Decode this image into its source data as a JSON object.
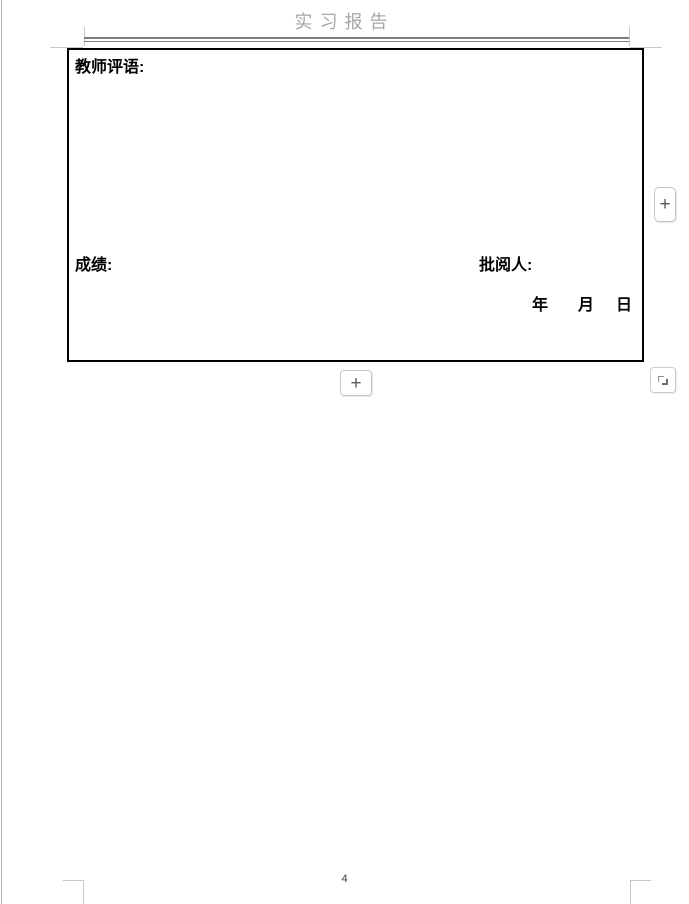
{
  "header": {
    "title": "实习报告"
  },
  "review_form": {
    "teacher_comment_label": "教师评语:",
    "grade_label": "成绩:",
    "reviewer_label": "批阅人:",
    "date": {
      "year": "年",
      "month": "月",
      "day": "日"
    }
  },
  "table_controls": {
    "add_row_icon": "+",
    "add_column_icon": "+",
    "resize_icon": "corner-resize"
  },
  "footer": {
    "page_number": "4"
  },
  "colors": {
    "header_text": "#a6a6a6",
    "header_rule": "#7c7c7c",
    "crop_mark": "#c8c8c8",
    "table_border": "#000000",
    "control_border": "#c6c6c6",
    "control_glyph": "#5a5a5a"
  }
}
